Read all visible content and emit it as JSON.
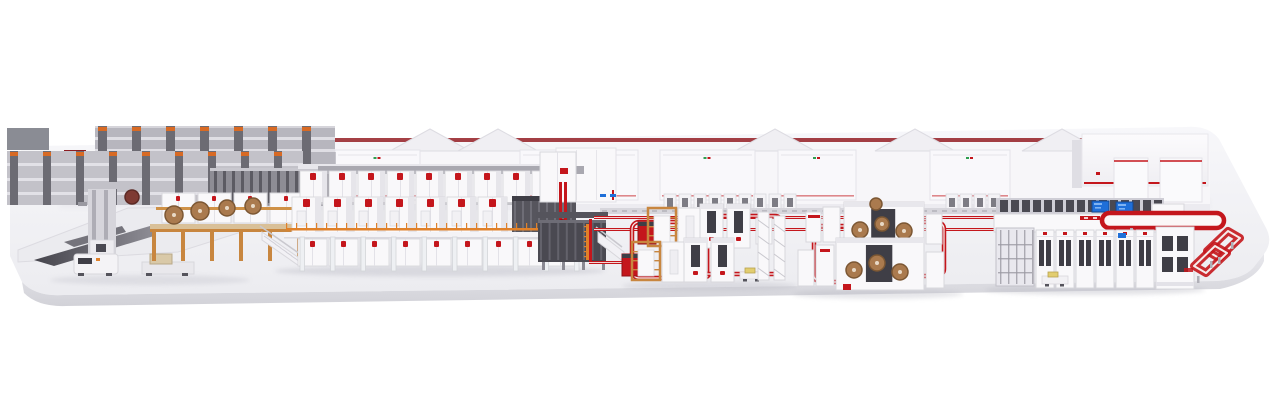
{
  "scene": {
    "type": "3d-plant-render",
    "sections": [
      {
        "id": "platform"
      },
      {
        "id": "background-buildings",
        "gable_roofs": 5,
        "hood_units": 5
      },
      {
        "id": "roll-storage-racking",
        "back_bays": 7,
        "front_bays": 9,
        "slat_count": 14
      },
      {
        "id": "left-logistics-area",
        "agv_count": 2
      },
      {
        "id": "splicer-mezzanine",
        "paper_rolls": 4,
        "splicer_cabinets": 4
      },
      {
        "id": "corrugator-line",
        "top_units": 9,
        "mid_units": 7,
        "bottom_units": 9,
        "support_legs": 10,
        "railing_posts": 31
      },
      {
        "id": "dry-end-section"
      },
      {
        "id": "floor-conveyor-lines",
        "floor_loops": 4
      },
      {
        "id": "converting-cluster-1",
        "machine_rows": 2
      },
      {
        "id": "converting-cluster-2",
        "machine_rows": 2,
        "die_cut_rolls": 7
      },
      {
        "id": "finishing-line",
        "front_cabinet_units": 6,
        "display_screens": 2,
        "window_count": 15
      },
      {
        "id": "elevated-loop-conveyor",
        "rings": 2
      }
    ]
  },
  "colors": {
    "background": "#ffffff",
    "machine_white": "#f9f8fa",
    "machine_shade": "#e6e5ea",
    "panel_line": "#d8d7dc",
    "dark_slot": "#3f3e46",
    "deep_dark": "#26262c",
    "steel_gray": "#9b9aa2",
    "rack_dark": "#6c6b73",
    "rack_light": "#c3c2c9",
    "accent_red": "#c4161c",
    "dark_red": "#8f1016",
    "orange": "#e0812a",
    "wood": "#c8863f",
    "roll_brown": "#aa7a4e",
    "roll_rim": "#7c5733",
    "screen_blue": "#1f6fd8",
    "leg_white": "#eef0f3",
    "shadow": "#b9b9c3",
    "logo_green": "#2e9e4f",
    "cart_yellow": "#e2cd6f"
  }
}
